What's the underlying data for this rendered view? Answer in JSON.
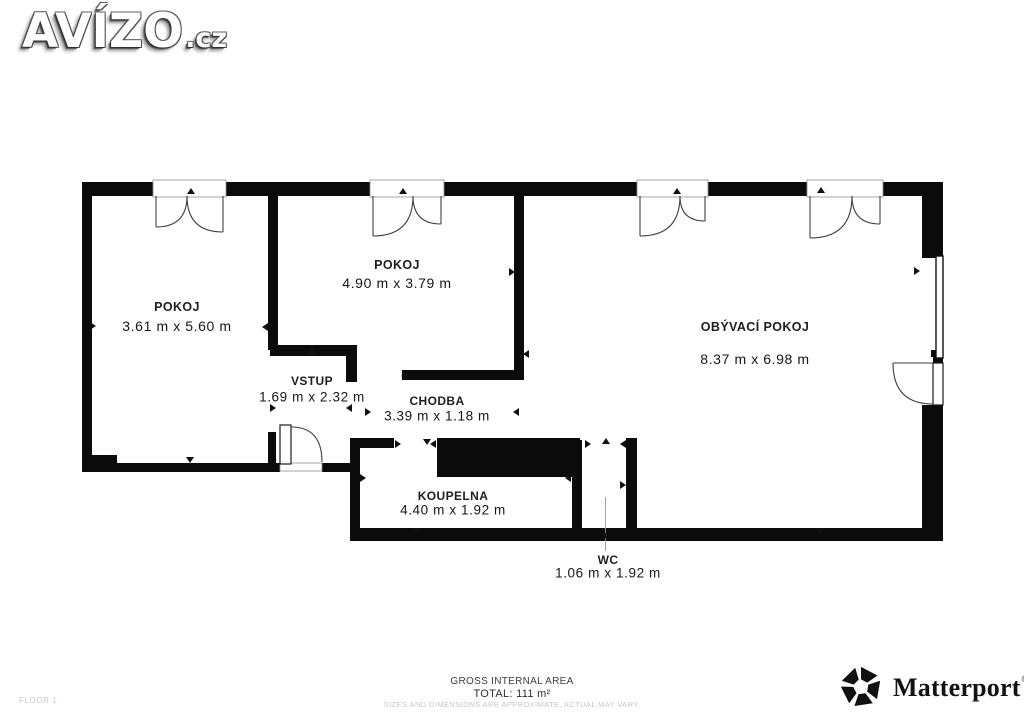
{
  "header": {
    "logo_main": "AVÍZO",
    "logo_suffix": ".cz"
  },
  "footer": {
    "floor_label": "FLOOR 1",
    "area_title": "GROSS INTERNAL AREA",
    "area_total": "TOTAL: 111 m²",
    "disclaimer": "SIZES AND DIMENSIONS ARE APPROXIMATE, ACTUAL MAY VARY.",
    "brand": "Matterport",
    "brand_reg": "®"
  },
  "colors": {
    "wall": "#0b0b0b",
    "line": "#3f3f3f",
    "frame": "#8f8f8f",
    "tick": "#111111",
    "leader": "#9a9a9a"
  },
  "plan": {
    "rooms": [
      {
        "name": "POKOJ",
        "dims": "3.61 m x 5.60 m",
        "cx": 177,
        "name_y": 307,
        "dims_y": 326,
        "cls": "lg"
      },
      {
        "name": "POKOJ",
        "dims": "4.90 m x 3.79 m",
        "cx": 397,
        "name_y": 265,
        "dims_y": 283,
        "cls": "lg"
      },
      {
        "name": "OBÝVACÍ POKOJ",
        "dims": "8.37 m x 6.98 m",
        "cx": 755,
        "name_y": 327,
        "dims_y": 359,
        "cls": "lg"
      },
      {
        "name": "VSTUP",
        "dims": "1.69 m x 2.32 m",
        "cx": 312,
        "name_y": 381,
        "dims_y": 397,
        "cls": "sm"
      },
      {
        "name": "CHODBA",
        "dims": "3.39 m x 1.18 m",
        "cx": 437,
        "name_y": 401,
        "dims_y": 416,
        "cls": "sm"
      },
      {
        "name": "KOUPELNA",
        "dims": "4.40 m x 1.92 m",
        "cx": 453,
        "name_y": 496,
        "dims_y": 510,
        "cls": "sm"
      },
      {
        "name": "WC",
        "dims": "1.06 m x 1.92 m",
        "cx": 608,
        "name_y": 560,
        "dims_y": 573,
        "cls": "sm"
      }
    ],
    "walls": [
      [
        82,
        182,
        74,
        14
      ],
      [
        223,
        182,
        150,
        14
      ],
      [
        441,
        182,
        199,
        14
      ],
      [
        705,
        182,
        105,
        14
      ],
      [
        880,
        182,
        63,
        14
      ],
      [
        82,
        196,
        10,
        276
      ],
      [
        82,
        455,
        35,
        17
      ],
      [
        117,
        463,
        151,
        9
      ],
      [
        268,
        432,
        8,
        31
      ],
      [
        268,
        463,
        12,
        9
      ],
      [
        322,
        463,
        30,
        9
      ],
      [
        268,
        196,
        10,
        154
      ],
      [
        270,
        345,
        83,
        11
      ],
      [
        346,
        345,
        11,
        37
      ],
      [
        514,
        196,
        10,
        184
      ],
      [
        402,
        370,
        122,
        10
      ],
      [
        350,
        438,
        10,
        103
      ],
      [
        360,
        438,
        34,
        10
      ],
      [
        437,
        438,
        143,
        39
      ],
      [
        572,
        440,
        10,
        101
      ],
      [
        626,
        438,
        11,
        103
      ],
      [
        350,
        528,
        593,
        13
      ],
      [
        922,
        196,
        21,
        62
      ],
      [
        933,
        356,
        10,
        9
      ],
      [
        922,
        405,
        21,
        136
      ],
      [
        931,
        350,
        7,
        7
      ]
    ],
    "double_doors": [
      {
        "x1": 156,
        "x2": 223,
        "r1": 31,
        "r2": 36
      },
      {
        "x1": 373,
        "x2": 441,
        "r1": 40,
        "r2": 28
      },
      {
        "x1": 640,
        "x2": 705,
        "r1": 40,
        "r2": 25
      },
      {
        "x1": 810,
        "x2": 880,
        "r1": 42,
        "r2": 28
      }
    ],
    "wall_bottom_y": 196,
    "frame_top_y": 180,
    "window": [
      936,
      256,
      7,
      102
    ],
    "entry_door": {
      "leaf": [
        280,
        425,
        11,
        39
      ],
      "arc": "M291,427 Q322,427 322,462",
      "threshold": [
        280,
        463,
        42,
        8
      ]
    },
    "right_door": {
      "leaf": [
        933,
        363,
        10,
        42
      ],
      "arc": "M893,363 Q893,404 933,404",
      "topline": [
        893,
        363,
        933,
        363
      ]
    },
    "leader": [
      605.5,
      497,
      605.5,
      551
    ],
    "ticks": {
      "up": [
        [
          191,
          191
        ],
        [
          403,
          191
        ],
        [
          677,
          191
        ],
        [
          821,
          190
        ],
        [
          312,
          351
        ],
        [
          606,
          441
        ]
      ],
      "down": [
        [
          190,
          460
        ],
        [
          418,
          531
        ],
        [
          820,
          531
        ],
        [
          605,
          536
        ],
        [
          427,
          442
        ]
      ],
      "left": [
        [
          265,
          327
        ],
        [
          526,
          354
        ],
        [
          568,
          478
        ],
        [
          433,
          444
        ],
        [
          349,
          408
        ],
        [
          516,
          412
        ],
        [
          404,
          376
        ],
        [
          623,
          444
        ]
      ],
      "right": [
        [
          93,
          326
        ],
        [
          512,
          272
        ],
        [
          917,
          271
        ],
        [
          363,
          478
        ],
        [
          398,
          444
        ],
        [
          273,
          408
        ],
        [
          368,
          412
        ],
        [
          588,
          444
        ],
        [
          623,
          485
        ]
      ]
    }
  }
}
